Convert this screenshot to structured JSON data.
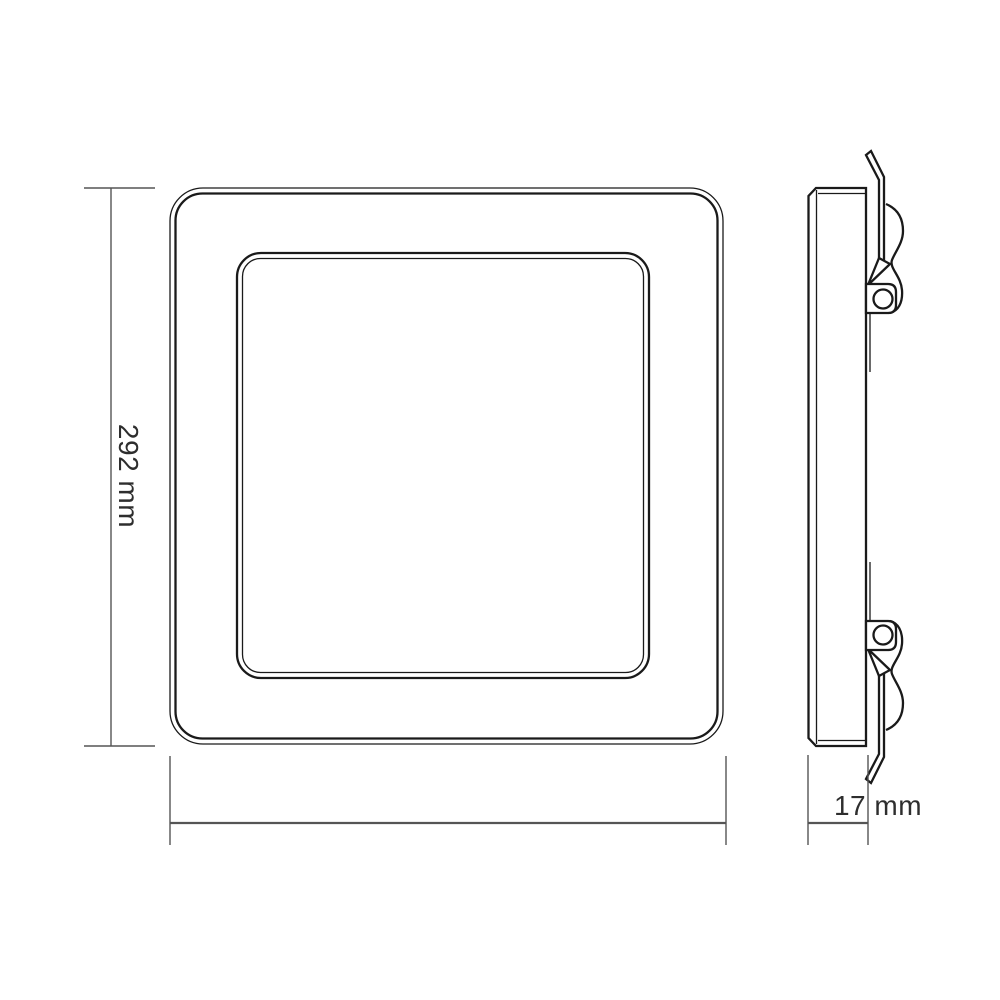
{
  "dimensions": {
    "height_label": "292 mm",
    "depth_label": "17 mm"
  },
  "colors": {
    "background": "#ffffff",
    "line": "#1a1a1a",
    "dimension_line": "#555555",
    "text": "#2e2e2e"
  }
}
